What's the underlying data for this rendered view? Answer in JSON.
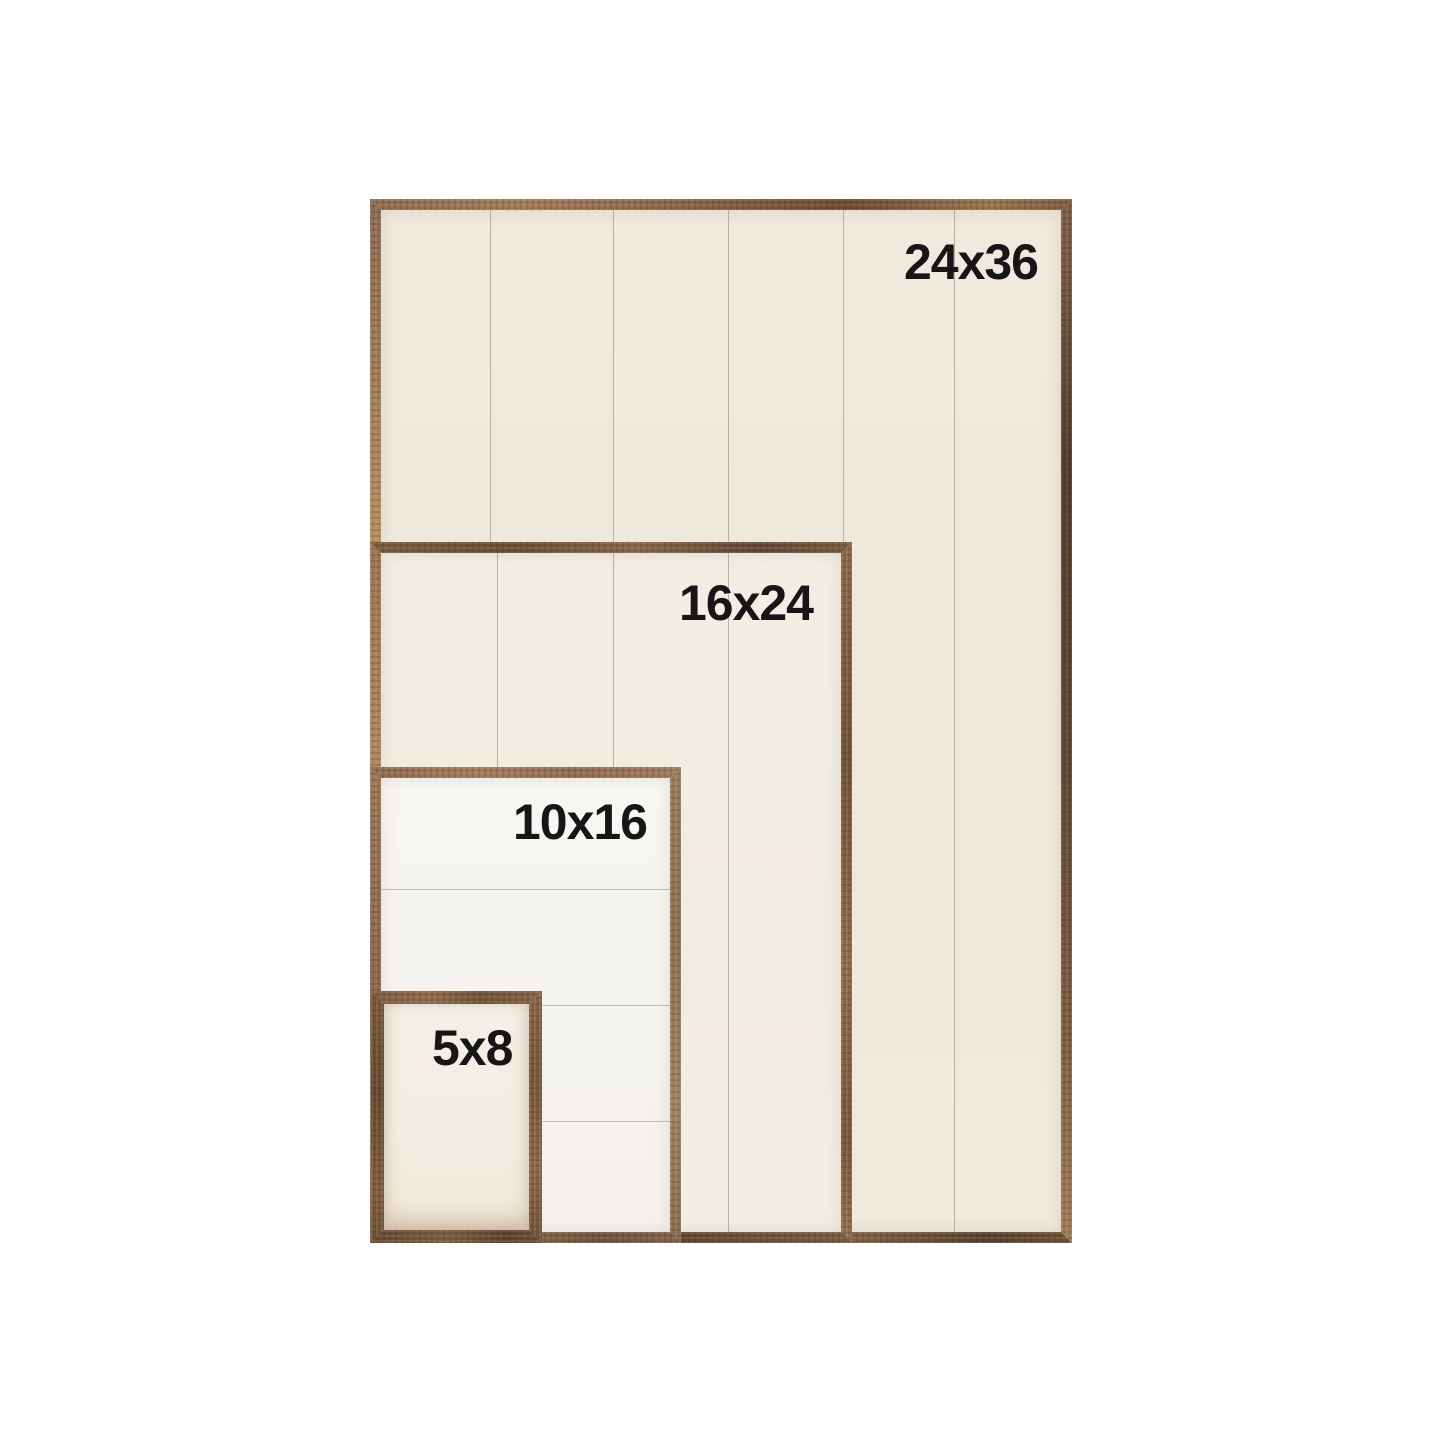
{
  "frames": [
    {
      "label": "24x36"
    },
    {
      "label": "16x24"
    },
    {
      "label": "10x16"
    },
    {
      "label": "5x8"
    }
  ],
  "colors": {
    "bg": "#ffffff",
    "ink": "#161616",
    "cream1": "#f0e9dd",
    "cream2": "#f3eee4",
    "white1": "#f8f6f3",
    "cream3": "#f4efe7"
  }
}
